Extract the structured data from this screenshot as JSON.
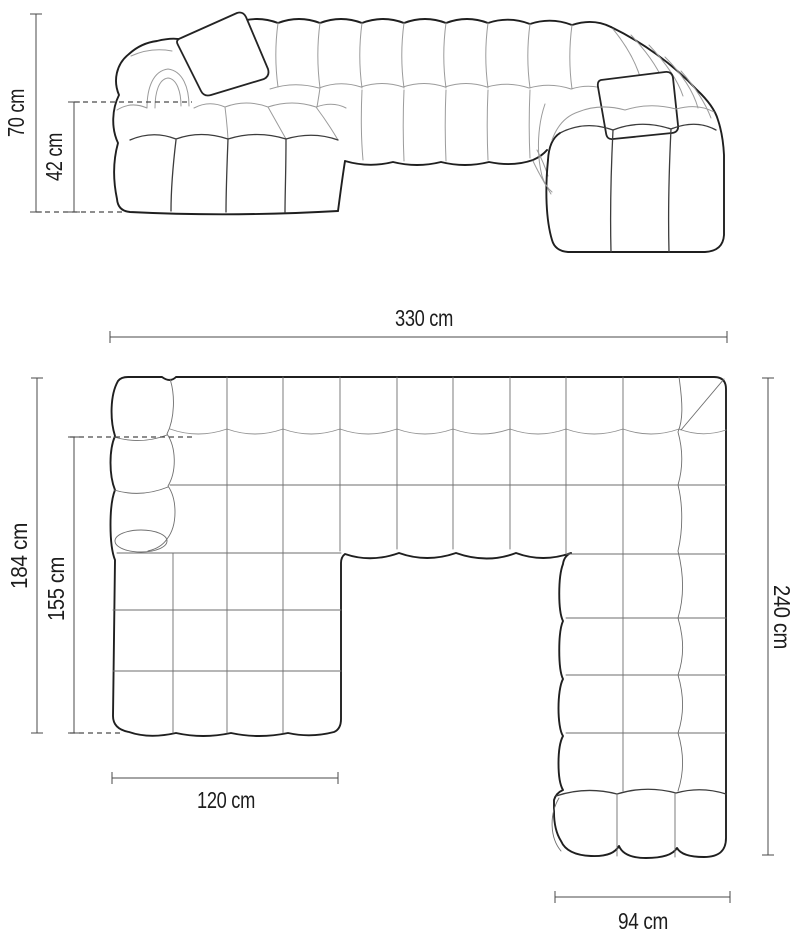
{
  "diagram": {
    "unit": "cm",
    "front_view": {
      "overall_height_label": "70 cm",
      "seat_height_label": "42 cm"
    },
    "plan_view": {
      "overall_width_label": "330 cm",
      "left_section_depth_label": "184 cm",
      "left_chaise_length_label": "155 cm",
      "right_section_depth_label": "240 cm",
      "left_chaise_width_label": "120 cm",
      "right_section_width_label": "94 cm"
    },
    "colors": {
      "background": "#ffffff",
      "outline": "#1f1f1f",
      "inner_seam": "#8f8f8f",
      "dimension_line": "#4a4a4a",
      "label_text": "#1d1d1d"
    }
  }
}
